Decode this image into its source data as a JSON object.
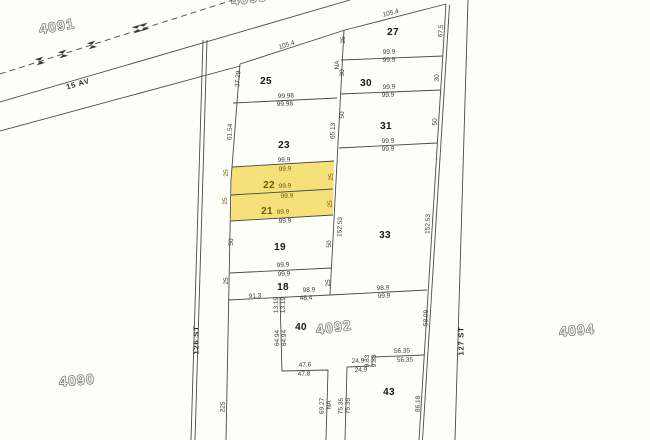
{
  "map": {
    "background": "#fdfdfa",
    "line_color": "#4a4a4a",
    "highlight": {
      "color": "#f6e07a",
      "lots": [
        "22",
        "21"
      ]
    },
    "labels": [
      {
        "text": "4091",
        "x": 57,
        "y": 26,
        "rot": -10,
        "cls": "block",
        "name": "block-number-4091"
      },
      {
        "text": "4093",
        "x": 249,
        "y": -2,
        "rot": -8,
        "cls": "block",
        "name": "block-number-4093"
      },
      {
        "text": "4090",
        "x": 77,
        "y": 380,
        "rot": -5,
        "cls": "block",
        "name": "block-number-4090"
      },
      {
        "text": "4092",
        "x": 334,
        "y": 327,
        "rot": -8,
        "cls": "block",
        "name": "block-number-4092"
      },
      {
        "text": "4094",
        "x": 577,
        "y": 330,
        "rot": -5,
        "cls": "block",
        "name": "block-number-4094"
      },
      {
        "text": "15 AV",
        "x": 78,
        "y": 84,
        "rot": -16,
        "cls": "street",
        "name": "street-label-15-av"
      },
      {
        "text": "126 ST",
        "x": 196,
        "y": 340,
        "rot": -90,
        "cls": "street",
        "name": "street-label-126-st"
      },
      {
        "text": "127 ST",
        "x": 461,
        "y": 341,
        "rot": -90,
        "cls": "street",
        "name": "street-label-127-st"
      },
      {
        "text": "25",
        "x": 266,
        "y": 82,
        "rot": 0,
        "cls": "lot",
        "name": "lot-number-25"
      },
      {
        "text": "27",
        "x": 393,
        "y": 33,
        "rot": 0,
        "cls": "lot",
        "name": "lot-number-27"
      },
      {
        "text": "30",
        "x": 366,
        "y": 84,
        "rot": 0,
        "cls": "lot",
        "name": "lot-number-30"
      },
      {
        "text": "31",
        "x": 386,
        "y": 127,
        "rot": 0,
        "cls": "lot",
        "name": "lot-number-31"
      },
      {
        "text": "23",
        "x": 284,
        "y": 146,
        "rot": 0,
        "cls": "lot",
        "name": "lot-number-23"
      },
      {
        "text": "22",
        "x": 269,
        "y": 186,
        "rot": 0,
        "cls": "lot lot-hl",
        "name": "lot-number-22"
      },
      {
        "text": "21",
        "x": 267,
        "y": 212,
        "rot": 0,
        "cls": "lot lot-hl",
        "name": "lot-number-21"
      },
      {
        "text": "19",
        "x": 280,
        "y": 248,
        "rot": 0,
        "cls": "lot",
        "name": "lot-number-19"
      },
      {
        "text": "18",
        "x": 283,
        "y": 288,
        "rot": 0,
        "cls": "lot",
        "name": "lot-number-18"
      },
      {
        "text": "33",
        "x": 385,
        "y": 236,
        "rot": 0,
        "cls": "lot",
        "name": "lot-number-33"
      },
      {
        "text": "40",
        "x": 301,
        "y": 328,
        "rot": 0,
        "cls": "lot",
        "name": "lot-number-40"
      },
      {
        "text": "43",
        "x": 389,
        "y": 393,
        "rot": 0,
        "cls": "lot",
        "name": "lot-number-43"
      },
      {
        "text": "105.4",
        "x": 287,
        "y": 46,
        "rot": -18,
        "cls": "dim",
        "name": "dimension-label"
      },
      {
        "text": "37.29",
        "x": 239,
        "y": 79,
        "rot": -86,
        "cls": "dim",
        "name": "dimension-label"
      },
      {
        "text": "99.98",
        "x": 286,
        "y": 97,
        "rot": -3,
        "cls": "dim",
        "name": "dimension-label"
      },
      {
        "text": "99.98",
        "x": 285,
        "y": 105,
        "rot": -3,
        "cls": "dim",
        "name": "dimension-label"
      },
      {
        "text": "61.54",
        "x": 231,
        "y": 132,
        "rot": -87,
        "cls": "dim",
        "name": "dimension-label"
      },
      {
        "text": "105.4",
        "x": 391,
        "y": 14,
        "rot": -14,
        "cls": "dim",
        "name": "dimension-label"
      },
      {
        "text": "67.5",
        "x": 442,
        "y": 31,
        "rot": -86,
        "cls": "dim",
        "name": "dimension-label"
      },
      {
        "text": "25",
        "x": 344,
        "y": 40,
        "rot": -90,
        "cls": "dim",
        "name": "dimension-label"
      },
      {
        "text": "NA",
        "x": 338,
        "y": 65,
        "rot": -90,
        "cls": "dim",
        "name": "dimension-label"
      },
      {
        "text": "30",
        "x": 343,
        "y": 73,
        "rot": -90,
        "cls": "dim",
        "name": "dimension-label"
      },
      {
        "text": "99.9",
        "x": 389,
        "y": 53,
        "rot": -2,
        "cls": "dim",
        "name": "dimension-label"
      },
      {
        "text": "99.9",
        "x": 389,
        "y": 61,
        "rot": -2,
        "cls": "dim",
        "name": "dimension-label"
      },
      {
        "text": "30",
        "x": 438,
        "y": 78,
        "rot": -88,
        "cls": "dim",
        "name": "dimension-label"
      },
      {
        "text": "99.9",
        "x": 389,
        "y": 88,
        "rot": -2,
        "cls": "dim",
        "name": "dimension-label"
      },
      {
        "text": "99.9",
        "x": 388,
        "y": 96,
        "rot": -2,
        "cls": "dim",
        "name": "dimension-label"
      },
      {
        "text": "50",
        "x": 436,
        "y": 122,
        "rot": -88,
        "cls": "dim",
        "name": "dimension-label"
      },
      {
        "text": "50",
        "x": 343,
        "y": 115,
        "rot": -90,
        "cls": "dim",
        "name": "dimension-label"
      },
      {
        "text": "65.13",
        "x": 334,
        "y": 131,
        "rot": -87,
        "cls": "dim",
        "name": "dimension-label"
      },
      {
        "text": "99.9",
        "x": 388,
        "y": 142,
        "rot": -2,
        "cls": "dim",
        "name": "dimension-label"
      },
      {
        "text": "99.9",
        "x": 388,
        "y": 150,
        "rot": -2,
        "cls": "dim",
        "name": "dimension-label"
      },
      {
        "text": "99.9",
        "x": 284,
        "y": 161,
        "rot": -3,
        "cls": "dim",
        "name": "dimension-label"
      },
      {
        "text": "99.9",
        "x": 285,
        "y": 170,
        "rot": -3,
        "cls": "dim dim-hl",
        "name": "dimension-label"
      },
      {
        "text": "25",
        "x": 227,
        "y": 173,
        "rot": -90,
        "cls": "dim dim-hl",
        "name": "dimension-label"
      },
      {
        "text": "25",
        "x": 332,
        "y": 177,
        "rot": -90,
        "cls": "dim dim-hl",
        "name": "dimension-label"
      },
      {
        "text": "99.9",
        "x": 285,
        "y": 187,
        "rot": -3,
        "cls": "dim dim-hl",
        "name": "dimension-label"
      },
      {
        "text": "99.9",
        "x": 287,
        "y": 197,
        "rot": -3,
        "cls": "dim dim-hl",
        "name": "dimension-label"
      },
      {
        "text": "25",
        "x": 226,
        "y": 201,
        "rot": -90,
        "cls": "dim dim-hl",
        "name": "dimension-label"
      },
      {
        "text": "25",
        "x": 331,
        "y": 204,
        "rot": -90,
        "cls": "dim dim-hl",
        "name": "dimension-label"
      },
      {
        "text": "99.9",
        "x": 283,
        "y": 213,
        "rot": -3,
        "cls": "dim dim-hl",
        "name": "dimension-label"
      },
      {
        "text": "99.9",
        "x": 285,
        "y": 222,
        "rot": -3,
        "cls": "dim",
        "name": "dimension-label"
      },
      {
        "text": "50",
        "x": 232,
        "y": 242,
        "rot": -90,
        "cls": "dim",
        "name": "dimension-label"
      },
      {
        "text": "50",
        "x": 330,
        "y": 244,
        "rot": -90,
        "cls": "dim",
        "name": "dimension-label"
      },
      {
        "text": "99.9",
        "x": 283,
        "y": 266,
        "rot": -3,
        "cls": "dim",
        "name": "dimension-label"
      },
      {
        "text": "99.9",
        "x": 284,
        "y": 275,
        "rot": -3,
        "cls": "dim",
        "name": "dimension-label"
      },
      {
        "text": "25",
        "x": 227,
        "y": 281,
        "rot": -90,
        "cls": "dim",
        "name": "dimension-label"
      },
      {
        "text": "25",
        "x": 329,
        "y": 283,
        "rot": -90,
        "cls": "dim",
        "name": "dimension-label"
      },
      {
        "text": "152.53",
        "x": 341,
        "y": 227,
        "rot": -88,
        "cls": "dim",
        "name": "dimension-label"
      },
      {
        "text": "152.53",
        "x": 429,
        "y": 224,
        "rot": -88,
        "cls": "dim",
        "name": "dimension-label"
      },
      {
        "text": "91.3",
        "x": 255,
        "y": 297,
        "rot": -3,
        "cls": "dim",
        "name": "dimension-label"
      },
      {
        "text": "98.9",
        "x": 309,
        "y": 291,
        "rot": -3,
        "cls": "dim",
        "name": "dimension-label"
      },
      {
        "text": "48.4",
        "x": 306,
        "y": 299,
        "rot": -3,
        "cls": "dim",
        "name": "dimension-label"
      },
      {
        "text": "13.19",
        "x": 277,
        "y": 305,
        "rot": -90,
        "cls": "dim",
        "name": "dimension-label"
      },
      {
        "text": "13.19",
        "x": 284,
        "y": 305,
        "rot": -90,
        "cls": "dim",
        "name": "dimension-label"
      },
      {
        "text": "98.9",
        "x": 383,
        "y": 289,
        "rot": -3,
        "cls": "dim",
        "name": "dimension-label"
      },
      {
        "text": "99.9",
        "x": 384,
        "y": 297,
        "rot": -3,
        "cls": "dim",
        "name": "dimension-label"
      },
      {
        "text": "58.09",
        "x": 427,
        "y": 318,
        "rot": -88,
        "cls": "dim",
        "name": "dimension-label"
      },
      {
        "text": "64.94",
        "x": 278,
        "y": 338,
        "rot": -90,
        "cls": "dim",
        "name": "dimension-label"
      },
      {
        "text": "64.94",
        "x": 285,
        "y": 338,
        "rot": -90,
        "cls": "dim",
        "name": "dimension-label"
      },
      {
        "text": "47.6",
        "x": 305,
        "y": 366,
        "rot": -2,
        "cls": "dim",
        "name": "dimension-label"
      },
      {
        "text": "47.8",
        "x": 304,
        "y": 375,
        "rot": -2,
        "cls": "dim",
        "name": "dimension-label"
      },
      {
        "text": "69.27",
        "x": 323,
        "y": 406,
        "rot": -89,
        "cls": "dim",
        "name": "dimension-label"
      },
      {
        "text": "NA",
        "x": 330,
        "y": 405,
        "rot": -89,
        "cls": "dim",
        "name": "dimension-label"
      },
      {
        "text": "75.35",
        "x": 342,
        "y": 406,
        "rot": -89,
        "cls": "dim",
        "name": "dimension-label"
      },
      {
        "text": "75.35",
        "x": 349,
        "y": 406,
        "rot": -89,
        "cls": "dim",
        "name": "dimension-label"
      },
      {
        "text": "24.9",
        "x": 358,
        "y": 362,
        "rot": -2,
        "cls": "dim",
        "name": "dimension-label"
      },
      {
        "text": "24.9",
        "x": 361,
        "y": 371,
        "rot": -2,
        "cls": "dim",
        "name": "dimension-label"
      },
      {
        "text": "9.83",
        "x": 368,
        "y": 361,
        "rot": -90,
        "cls": "dim",
        "name": "dimension-label"
      },
      {
        "text": "9.83",
        "x": 375,
        "y": 361,
        "rot": -90,
        "cls": "dim",
        "name": "dimension-label"
      },
      {
        "text": "56.35",
        "x": 402,
        "y": 352,
        "rot": -2,
        "cls": "dim",
        "name": "dimension-label"
      },
      {
        "text": "56.35",
        "x": 405,
        "y": 361,
        "rot": -2,
        "cls": "dim",
        "name": "dimension-label"
      },
      {
        "text": "86.18",
        "x": 419,
        "y": 404,
        "rot": -88,
        "cls": "dim",
        "name": "dimension-label"
      },
      {
        "text": "225",
        "x": 224,
        "y": 407,
        "rot": -88,
        "cls": "dim",
        "name": "dimension-label"
      }
    ]
  }
}
